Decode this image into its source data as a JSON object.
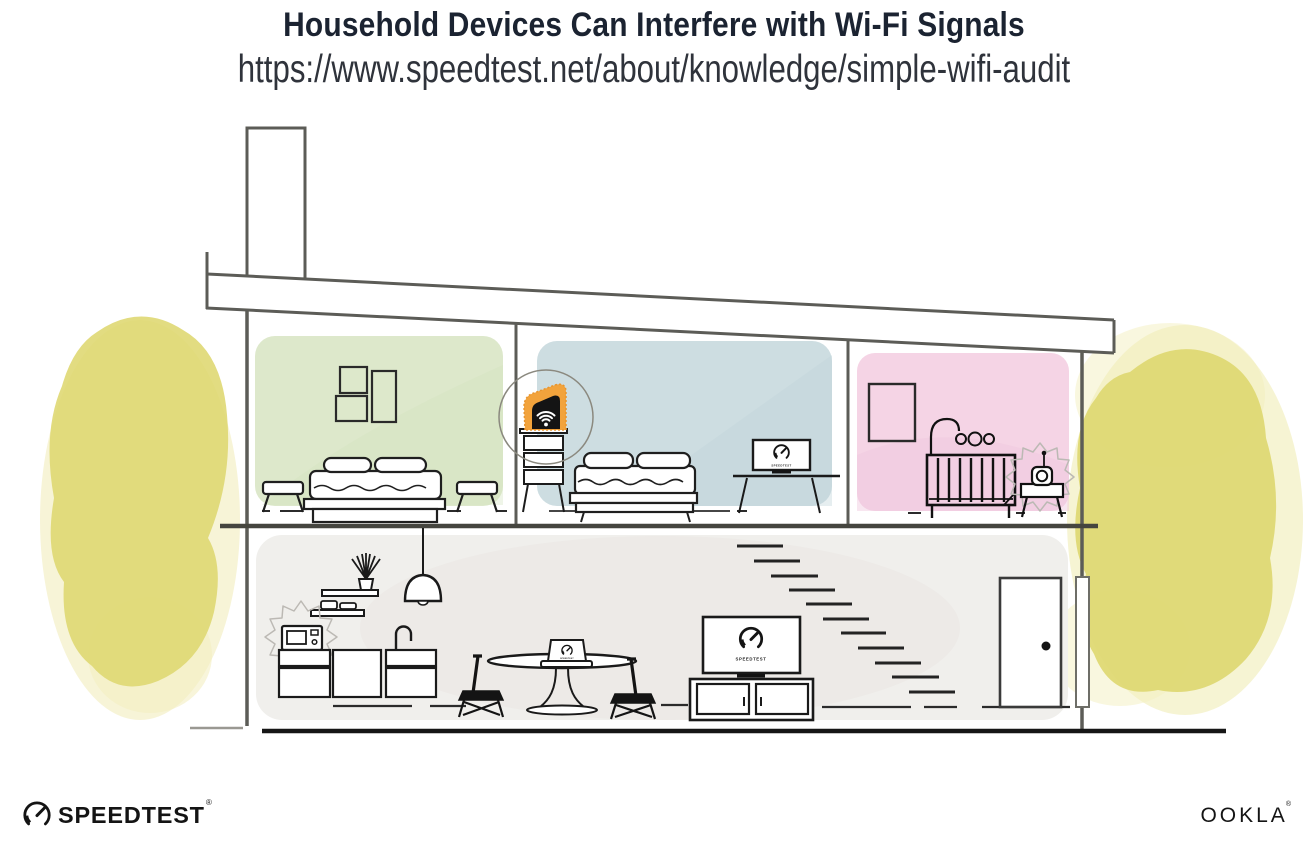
{
  "header": {
    "title": "Household Devices Can Interfere with Wi-Fi Signals",
    "url": "https://www.speedtest.net/about/knowledge/simple-wifi-audit"
  },
  "branding": {
    "speedtest_label": "SPEEDTEST",
    "speedtest_reg": "®",
    "ookla_label": "OOKLA",
    "ookla_reg": "®"
  },
  "illustration": {
    "screens_label": "SPEEDTEST",
    "colors": {
      "router_highlight": "#f2a33c",
      "foliage": "#ded76f",
      "house_outline": "#5c5c57",
      "ink": "#1a1a1a",
      "ground_line": "#161616"
    },
    "rooms": [
      {
        "name": "bedroom-green",
        "color": "#dde8cb"
      },
      {
        "name": "bedroom-blue",
        "color": "#cddde1"
      },
      {
        "name": "nursery-pink",
        "color": "#f5d4e5"
      },
      {
        "name": "ground-floor",
        "color": "#f0efec"
      }
    ],
    "elements": [
      "wifi-router",
      "microwave-oven",
      "baby-monitor",
      "tv-speedtest-screen",
      "desktop-monitor-speedtest-screen",
      "laptop-speedtest-screen",
      "bed",
      "crib",
      "dining-table",
      "kitchen-cabinets",
      "stairs",
      "front-door",
      "chimney",
      "pendant-lamp",
      "foliage"
    ]
  }
}
